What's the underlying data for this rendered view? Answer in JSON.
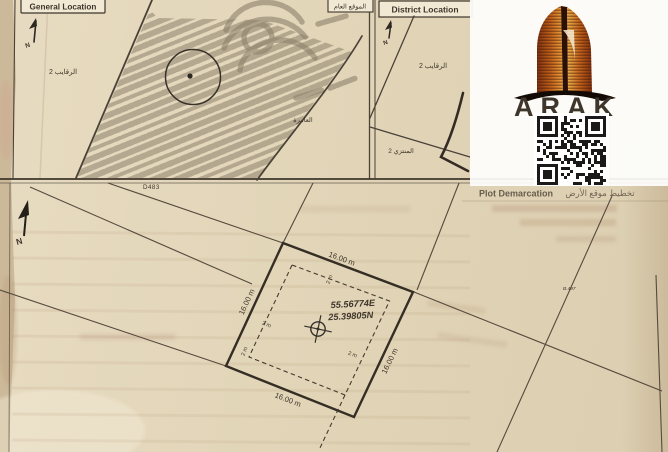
{
  "general_panel": {
    "title_en": "General Location",
    "title_ar": "الموقع العام",
    "district_label": "الرقايب 2",
    "area_label": "العامرة",
    "north_label": "N"
  },
  "district_panel": {
    "title_en": "District Location",
    "district_label": "الرقايب 2",
    "area_label": "المنتزي 2",
    "north_label": "N"
  },
  "plot_panel": {
    "header_en": "Plot Demarcation",
    "header_ar": "تخطيط موقع الأرض",
    "road_label": "D483",
    "north_label": "N",
    "ref_label": "B.497",
    "coord_e": "55.56774E",
    "coord_n": "25.39805N",
    "dims": {
      "top": "16.00 m",
      "right": "16.00 m",
      "bottom": "16.00 m",
      "left": "16.00 m"
    },
    "setbacks": [
      "2 m",
      "2 m",
      "2 m",
      "2 m"
    ]
  },
  "logo": {
    "brand": "ARAK"
  },
  "colors": {
    "paper": "#e3d6bb",
    "ink": "#4a4238",
    "accent_orange": "#c96a1f",
    "qr": "#1c1a18"
  }
}
